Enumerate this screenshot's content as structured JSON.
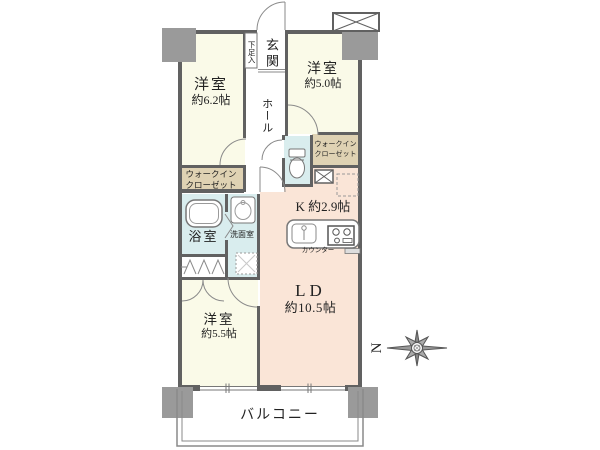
{
  "plan": {
    "rooms": {
      "bedroom1": {
        "name": "洋室",
        "size": "約6.2帖"
      },
      "bedroom2": {
        "name": "洋室",
        "size": "約5.0帖"
      },
      "bedroom3": {
        "name": "洋室",
        "size": "約5.5帖"
      },
      "living_dining": {
        "name": "LD",
        "size": "約10.5帖"
      },
      "kitchen": {
        "label": "K 約2.9帖"
      },
      "kitchen_counter": {
        "label": "カウンター"
      },
      "entrance": {
        "label": "玄関"
      },
      "shoe_cabinet": {
        "label": "下足入"
      },
      "hall": {
        "label": "ホール"
      },
      "walk_in_closet_left": {
        "line1": "ウォークイン",
        "line2": "クローゼット"
      },
      "walk_in_closet_right": {
        "line1": "ウォークイン",
        "line2": "クローゼット"
      },
      "bathroom": {
        "label": "浴室"
      },
      "washroom": {
        "label": "洗面室"
      },
      "balcony": {
        "label": "バルコニー"
      }
    },
    "compass": {
      "label": "N"
    },
    "colors": {
      "room-cream": "#FAFAE8",
      "room-peach": "#FAE5D7",
      "closet-beige": "#DFD2B3",
      "wet-blue": "#D9EDEE",
      "pillar-gray": "#9A9A9A",
      "wall-gray": "#616161"
    }
  }
}
